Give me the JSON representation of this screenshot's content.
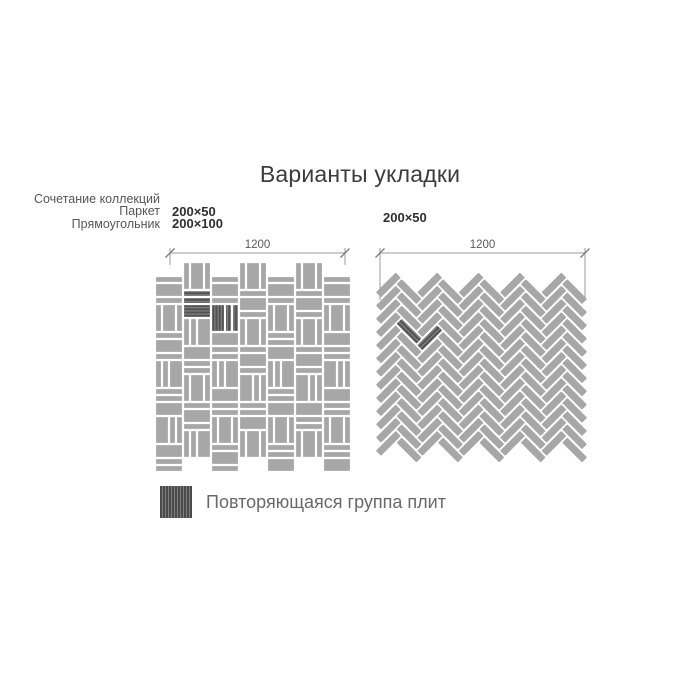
{
  "title": "Варианты укладки",
  "left_diagram": {
    "collection_note": "Сочетание коллекций",
    "collections": [
      {
        "name": "Паркет",
        "size": "200×50"
      },
      {
        "name": "Прямоугольник",
        "size": "200×100"
      }
    ],
    "dimension": "1200"
  },
  "right_diagram": {
    "size": "200×50",
    "dimension": "1200"
  },
  "legend": {
    "swatch": "hatched-dark-square",
    "label": "Повторяющаяся группа плит"
  },
  "colors": {
    "background": "#ffffff",
    "tile": "#a7a7a7",
    "dark_tile": "#535353",
    "dark_tile_line": "#8a8a8a",
    "dim_line": "#9a9a9a",
    "dim_tick": "#7a7a7a",
    "gap": "#ffffff"
  },
  "dims": {
    "left": {
      "x1": 170,
      "x2": 345,
      "y": 253,
      "drop": 12
    },
    "right": {
      "x1": 380,
      "x2": 585,
      "y": 253,
      "drop": 47
    }
  },
  "patterns": {
    "parquet": {
      "x0": 155,
      "y0": 262,
      "unit": 28,
      "cols": 7,
      "rows": 7,
      "gap": 2.2,
      "even_col_offset": 14,
      "scale_px_per_mm": 0.14,
      "piece_permutations_mm": [
        [
          50,
          100,
          50
        ],
        [
          100,
          50,
          50
        ],
        [
          50,
          50,
          100
        ],
        [
          50,
          100,
          50
        ]
      ],
      "seed": 7,
      "dark_cells": [
        [
          1,
          1
        ],
        [
          2,
          1
        ]
      ]
    },
    "herringbone": {
      "x0": 378,
      "y_top": 285,
      "col_w": 20.7,
      "cols": 10,
      "rows": 13,
      "period": 13.2,
      "odd_offset": 6.6,
      "tile_l": 28,
      "tile_w": 7.2,
      "dark_tiles": [
        [
          1,
          3
        ],
        [
          2,
          4
        ]
      ]
    }
  }
}
